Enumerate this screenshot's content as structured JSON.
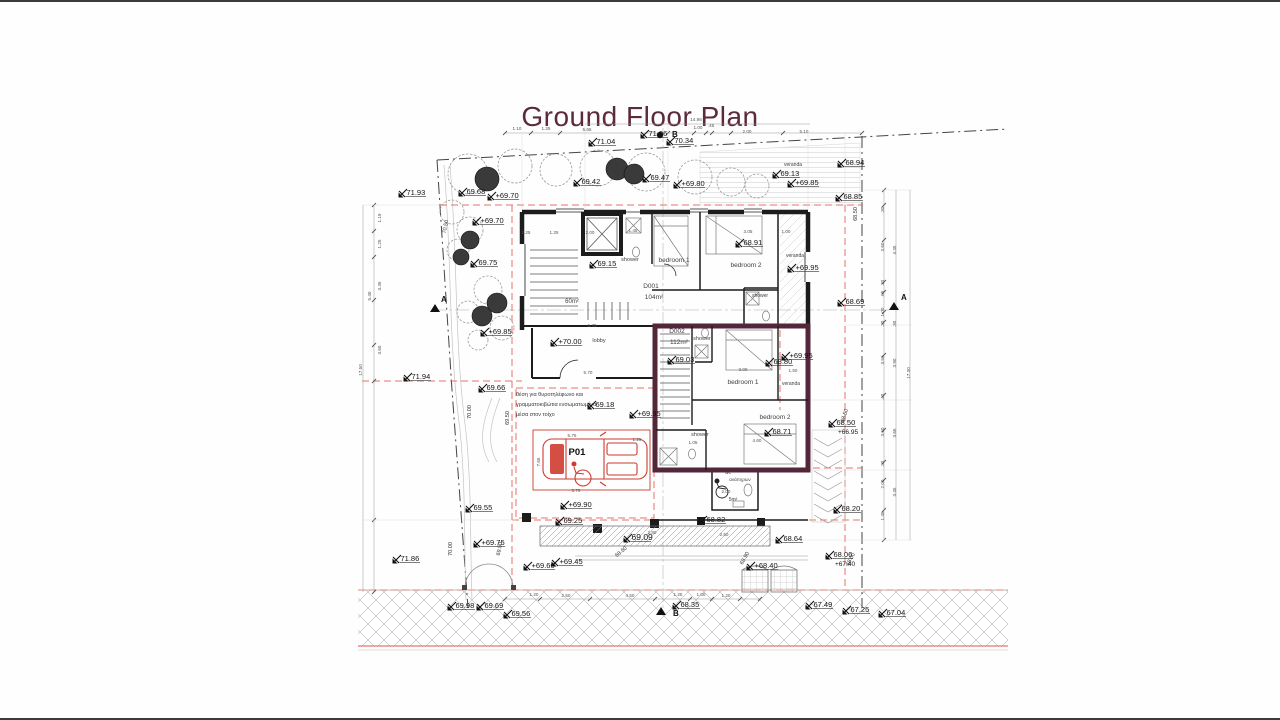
{
  "title": "Ground Floor Plan",
  "colors": {
    "title_text": "#5d2a3d",
    "unit_wall": "#53263a",
    "red_line": "#e4736b",
    "car_red": "#cf3b2f"
  },
  "plan": {
    "spot_levels": [
      {
        "t": "71.04",
        "x": 593,
        "y": 142
      },
      {
        "t": "71.06",
        "x": 645,
        "y": 134
      },
      {
        "t": "70.34",
        "x": 671,
        "y": 141
      },
      {
        "t": "69.42",
        "x": 578,
        "y": 182
      },
      {
        "t": "69.47",
        "x": 647,
        "y": 178
      },
      {
        "t": "+69.80",
        "x": 678,
        "y": 184
      },
      {
        "t": "69.68",
        "x": 463,
        "y": 192
      },
      {
        "t": "+69.70",
        "x": 492,
        "y": 196
      },
      {
        "t": "71.93",
        "x": 403,
        "y": 193
      },
      {
        "t": "+69.70",
        "x": 477,
        "y": 221
      },
      {
        "t": "69.75",
        "x": 475,
        "y": 263
      },
      {
        "t": "+69.85",
        "x": 485,
        "y": 332
      },
      {
        "t": "71.94",
        "x": 408,
        "y": 377
      },
      {
        "t": "69.66",
        "x": 483,
        "y": 388
      },
      {
        "t": "71.86",
        "x": 397,
        "y": 559
      },
      {
        "t": "69.13",
        "x": 777,
        "y": 174
      },
      {
        "t": "+69.85",
        "x": 792,
        "y": 183
      },
      {
        "t": "68.94",
        "x": 842,
        "y": 163
      },
      {
        "t": "68.85",
        "x": 840,
        "y": 197
      },
      {
        "t": "69.15",
        "x": 594,
        "y": 264
      },
      {
        "t": "68.91",
        "x": 740,
        "y": 243
      },
      {
        "t": "+70.00",
        "x": 555,
        "y": 342
      },
      {
        "t": "69.03",
        "x": 672,
        "y": 360
      },
      {
        "t": "68.80",
        "x": 770,
        "y": 362
      },
      {
        "t": "+69.95",
        "x": 786,
        "y": 356
      },
      {
        "t": "+69.95",
        "x": 792,
        "y": 268
      },
      {
        "t": "68.71",
        "x": 769,
        "y": 432
      },
      {
        "t": "+69.95",
        "x": 634,
        "y": 414
      },
      {
        "t": "69.18",
        "x": 592,
        "y": 405
      },
      {
        "t": "68.69",
        "x": 842,
        "y": 302
      },
      {
        "t": "68.50",
        "t2": "+66.95",
        "x": 833,
        "y": 423
      },
      {
        "t": "68.20",
        "x": 838,
        "y": 509
      },
      {
        "t": "69.55",
        "x": 470,
        "y": 508
      },
      {
        "t": "+69.90",
        "x": 565,
        "y": 505
      },
      {
        "t": "69.25",
        "x": 560,
        "y": 521
      },
      {
        "t": "69.09",
        "x": 628,
        "y": 538,
        "s": 8.5
      },
      {
        "t": "+69.60",
        "x": 528,
        "y": 566
      },
      {
        "t": "+69.45",
        "x": 556,
        "y": 562
      },
      {
        "t": "+69.75",
        "x": 478,
        "y": 543
      },
      {
        "t": "69.98",
        "x": 452,
        "y": 606
      },
      {
        "t": "69.69",
        "x": 481,
        "y": 606
      },
      {
        "t": "69.56",
        "x": 508,
        "y": 614
      },
      {
        "t": "68.82",
        "x": 703,
        "y": 520
      },
      {
        "t": "68.64",
        "x": 780,
        "y": 539
      },
      {
        "t": "+68.40",
        "x": 751,
        "y": 566
      },
      {
        "t": "68.35",
        "x": 677,
        "y": 605
      },
      {
        "t": "68.06",
        "t2": "+67.40",
        "x": 830,
        "y": 555
      },
      {
        "t": "67.49",
        "x": 810,
        "y": 605
      },
      {
        "t": "67.25",
        "x": 847,
        "y": 610
      },
      {
        "t": "67.04",
        "x": 883,
        "y": 613
      }
    ],
    "room_labels": [
      {
        "t": "shower",
        "x": 630,
        "y": 261,
        "s": 5.5
      },
      {
        "t": "bedroom 1",
        "x": 674,
        "y": 262,
        "s": 6.5
      },
      {
        "t": "bedroom 2",
        "x": 746,
        "y": 267,
        "s": 6.5
      },
      {
        "t": "shower",
        "x": 760,
        "y": 297,
        "s": 5
      },
      {
        "t": "veranda",
        "x": 795,
        "y": 257,
        "s": 5
      },
      {
        "t": "60m²",
        "x": 572,
        "y": 303,
        "s": 6
      },
      {
        "t": "D001",
        "x": 651,
        "y": 288,
        "s": 6.5
      },
      {
        "t": "104m²",
        "x": 654,
        "y": 299,
        "s": 6.5
      },
      {
        "t": "lobby",
        "x": 599,
        "y": 342,
        "s": 5.5
      },
      {
        "t": "D002",
        "x": 677,
        "y": 333,
        "s": 6.5
      },
      {
        "t": "112m²",
        "x": 679,
        "y": 344,
        "s": 6.5
      },
      {
        "t": "shower",
        "x": 702,
        "y": 340,
        "s": 5.5
      },
      {
        "t": "bedroom 1",
        "x": 743,
        "y": 384,
        "s": 6.5
      },
      {
        "t": "veranda",
        "x": 791,
        "y": 385,
        "s": 5
      },
      {
        "t": "bedroom 2",
        "x": 775,
        "y": 419,
        "s": 6.5
      },
      {
        "t": "shower",
        "x": 700,
        "y": 436,
        "s": 5.5
      },
      {
        "t": "wc",
        "x": 728,
        "y": 474,
        "s": 5
      },
      {
        "t": "ανάπηρων",
        "x": 740,
        "y": 481,
        "s": 4.5
      },
      {
        "t": "5m²",
        "x": 733,
        "y": 501,
        "s": 5
      },
      {
        "t": "veranda",
        "x": 793,
        "y": 166,
        "s": 5
      },
      {
        "t": "P01",
        "x": 577,
        "y": 455,
        "s": 9.5,
        "c": "#111111",
        "w": "600"
      }
    ],
    "note_lines": [
      {
        "t": "θέση για θυροτηλέφωνο και",
        "x": 516,
        "y": 396
      },
      {
        "t": "γραμματοκιβώτια ενσωματωμένα",
        "x": 516,
        "y": 406
      },
      {
        "t": "μέσα στον τοίχο",
        "x": 516,
        "y": 416
      }
    ],
    "dim_labels": [
      {
        "t": "14.98",
        "x": 696,
        "y": 121
      },
      {
        "t": "1.10",
        "x": 517,
        "y": 130
      },
      {
        "t": "1.25",
        "x": 546,
        "y": 130
      },
      {
        "t": "5.65",
        "x": 587,
        "y": 131
      },
      {
        "t": "1.00",
        "x": 698,
        "y": 129
      },
      {
        "t": ".45",
        "x": 711,
        "y": 127
      },
      {
        "t": "2.00",
        "x": 747,
        "y": 133
      },
      {
        "t": "5.10",
        "x": 804,
        "y": 133
      },
      {
        "t": "1.19",
        "x": 381,
        "y": 218,
        "r": -90
      },
      {
        "t": "1.25",
        "x": 381,
        "y": 244,
        "r": -90
      },
      {
        "t": "3.45",
        "x": 381,
        "y": 286,
        "r": -90
      },
      {
        "t": "5.40",
        "x": 371,
        "y": 296,
        "r": -90
      },
      {
        "t": "3.60",
        "x": 381,
        "y": 350,
        "r": -90
      },
      {
        "t": "17.50",
        "x": 362,
        "y": 370,
        "r": -90
      },
      {
        "t": ".30",
        "x": 884,
        "y": 210,
        "r": -90
      },
      {
        "t": "3.60",
        "x": 884,
        "y": 247,
        "r": -90
      },
      {
        "t": "4.35",
        "x": 896,
        "y": 250,
        "r": -90
      },
      {
        "t": ".30",
        "x": 884,
        "y": 283,
        "r": -90
      },
      {
        "t": ".65",
        "x": 884,
        "y": 294,
        "r": -90
      },
      {
        "t": "1.00",
        "x": 884,
        "y": 312,
        "r": -90
      },
      {
        "t": ".30",
        "x": 884,
        "y": 324,
        "r": -90
      },
      {
        "t": ".30",
        "x": 896,
        "y": 324,
        "r": -90
      },
      {
        "t": "3.50",
        "x": 884,
        "y": 360,
        "r": -90
      },
      {
        "t": "3.90",
        "x": 896,
        "y": 363,
        "r": -90
      },
      {
        "t": "17.30",
        "x": 910,
        "y": 373,
        "r": -90
      },
      {
        "t": ".40",
        "x": 884,
        "y": 397,
        "r": -90
      },
      {
        "t": "3.60",
        "x": 884,
        "y": 432,
        "r": -90
      },
      {
        "t": "3.65",
        "x": 896,
        "y": 433,
        "r": -90
      },
      {
        "t": ".30",
        "x": 884,
        "y": 464,
        "r": -90
      },
      {
        "t": "2.00",
        "x": 884,
        "y": 484,
        "r": -90
      },
      {
        "t": "3.45",
        "x": 896,
        "y": 492,
        "r": -90
      },
      {
        "t": "1.45",
        "x": 884,
        "y": 516,
        "r": -90
      },
      {
        "t": "1.20",
        "x": 534,
        "y": 596
      },
      {
        "t": "2.50",
        "x": 566,
        "y": 597
      },
      {
        "t": "4.50",
        "x": 630,
        "y": 597
      },
      {
        "t": "1.25",
        "x": 678,
        "y": 596
      },
      {
        "t": "1.00",
        "x": 701,
        "y": 596
      },
      {
        "t": "1.20",
        "x": 726,
        "y": 597
      },
      {
        "t": "2.80",
        "x": 652,
        "y": 534
      },
      {
        "t": "2.50",
        "x": 724,
        "y": 536
      },
      {
        "t": "1.25",
        "x": 526,
        "y": 234
      },
      {
        "t": "1.25",
        "x": 554,
        "y": 234
      },
      {
        "t": "2.00",
        "x": 590,
        "y": 234
      },
      {
        "t": "1.45",
        "x": 633,
        "y": 232
      },
      {
        "t": "3.05",
        "x": 748,
        "y": 233
      },
      {
        "t": "1.00",
        "x": 786,
        "y": 233
      },
      {
        "t": "6.70",
        "x": 592,
        "y": 327
      },
      {
        "t": "5.70",
        "x": 588,
        "y": 374
      },
      {
        "t": "3.00",
        "x": 743,
        "y": 371
      },
      {
        "t": "1.50",
        "x": 793,
        "y": 372
      },
      {
        "t": "4.60",
        "x": 757,
        "y": 442
      },
      {
        "t": "1.05",
        "x": 693,
        "y": 444
      },
      {
        "t": "2.00",
        "x": 726,
        "y": 493
      },
      {
        "t": "5.75",
        "x": 572,
        "y": 437
      },
      {
        "t": "5.75",
        "x": 576,
        "y": 492
      },
      {
        "t": "7.65",
        "x": 540,
        "y": 462,
        "r": -90
      },
      {
        "t": "1.25",
        "x": 637,
        "y": 441
      }
    ],
    "rotated_labels": [
      {
        "t": "70.50",
        "x": 447,
        "y": 227,
        "r": -78
      },
      {
        "t": "70.00",
        "x": 471,
        "y": 412,
        "r": -90
      },
      {
        "t": "69.50",
        "x": 509,
        "y": 418,
        "r": -90
      },
      {
        "t": "70.00",
        "x": 452,
        "y": 549,
        "r": -90
      },
      {
        "t": "69.50",
        "x": 501,
        "y": 549,
        "r": -80
      },
      {
        "t": "68.60",
        "x": 622,
        "y": 553,
        "r": -40
      },
      {
        "t": "68.90",
        "x": 746,
        "y": 559,
        "r": -60
      },
      {
        "t": "68.00",
        "x": 852,
        "y": 560,
        "r": -62
      },
      {
        "t": "68.50",
        "x": 857,
        "y": 214,
        "r": -90
      },
      {
        "t": "68.50",
        "x": 846,
        "y": 416,
        "r": -72
      }
    ],
    "section_markers": [
      {
        "t": "A",
        "x": 437,
        "y": 299,
        "mx": 435,
        "my": 308
      },
      {
        "t": "A",
        "x": 897,
        "y": 297,
        "mx": 894,
        "my": 306
      },
      {
        "t": "B",
        "x": 668,
        "y": 134,
        "mx": 660,
        "my": 135,
        "kind": "dot"
      },
      {
        "t": "B",
        "x": 669,
        "y": 613,
        "mx": 661,
        "my": 611
      }
    ]
  }
}
